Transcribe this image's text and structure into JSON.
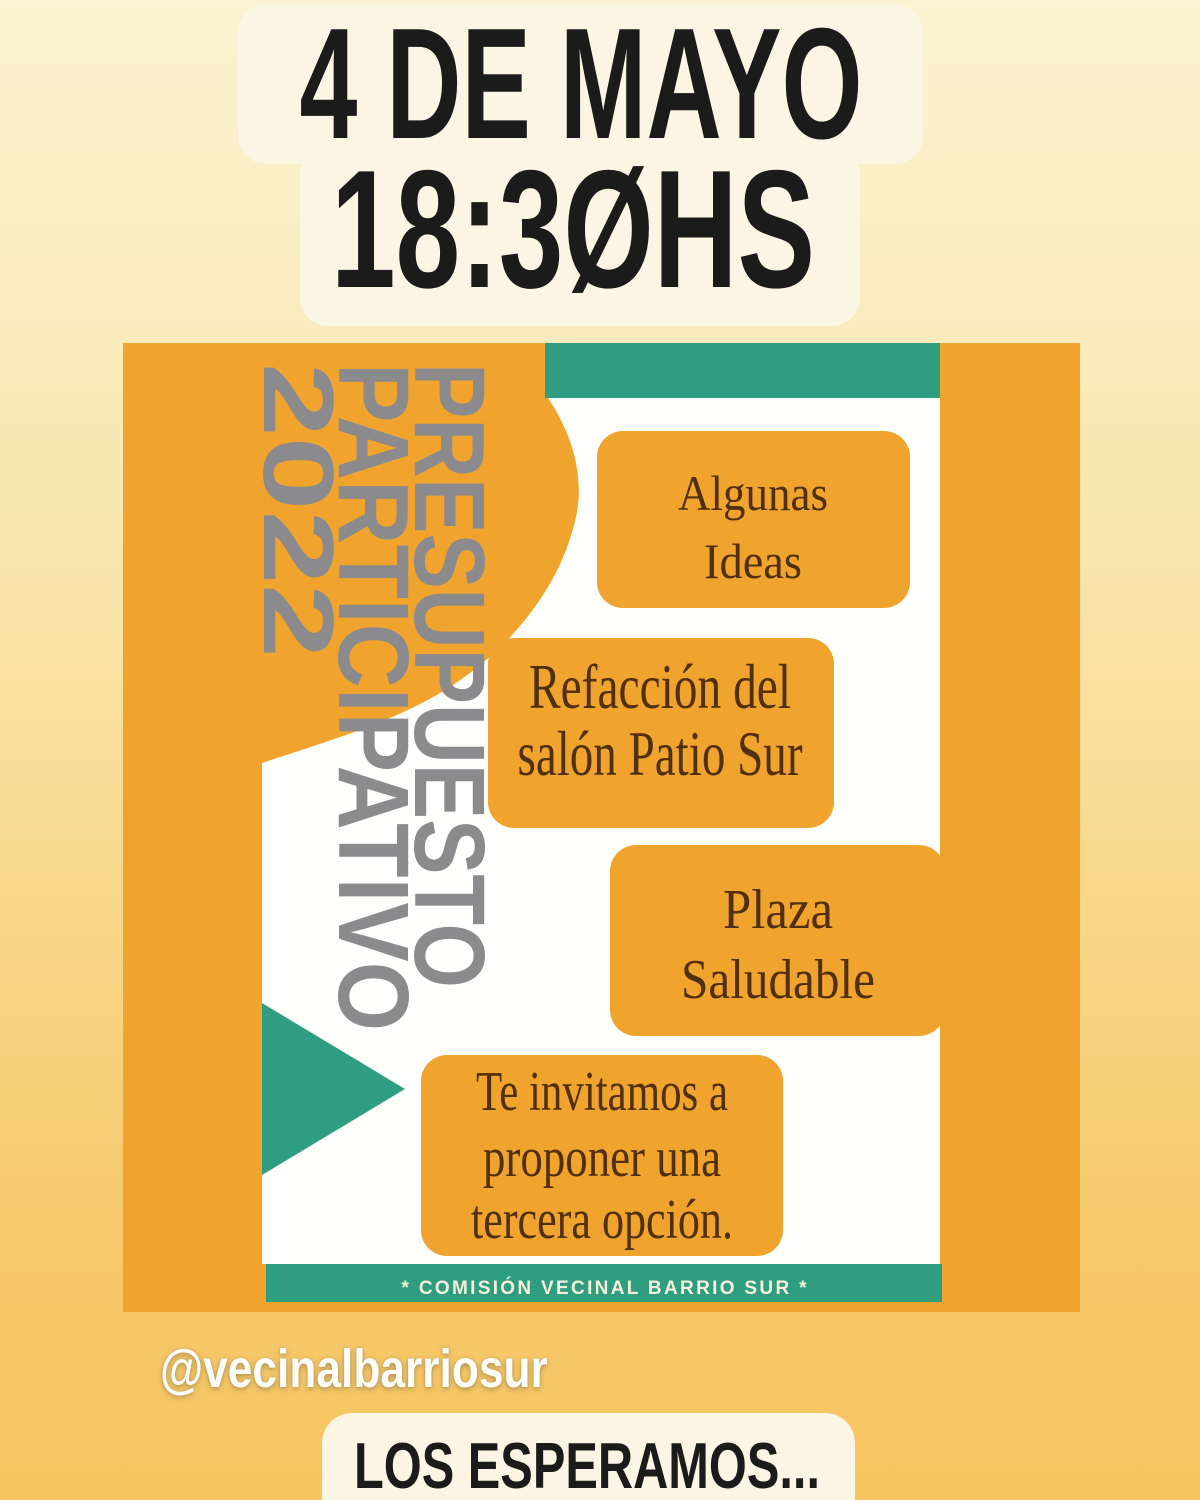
{
  "title": {
    "line1": "4 DE MAYO",
    "line2": "18:3ØHS"
  },
  "flyer": {
    "vertical_title": {
      "lines": [
        "PRESUPUESTO",
        "PARTICIPATIVO",
        "2022"
      ]
    },
    "idea_boxes": [
      {
        "id": "algunas-ideas",
        "lines": [
          "Algunas",
          "Ideas"
        ]
      },
      {
        "id": "refaccion-salon",
        "lines": [
          "Refacción del",
          "salón Patio Sur"
        ]
      },
      {
        "id": "plaza-saludable",
        "lines": [
          "Plaza",
          "Saludable"
        ]
      },
      {
        "id": "tercera-opcion",
        "lines": [
          "Te invitamos a",
          "proponer una",
          "tercera opción."
        ]
      }
    ],
    "footer_bar": "* COMISIÓN VECINAL BARRIO SUR *"
  },
  "mention": "@vecinalbarriosur",
  "footer": {
    "text": "LOS ESPERAMOS..."
  },
  "colors": {
    "background_top": "#FAF2D0",
    "background_bottom": "#F7C45F",
    "flyer_orange": "#F0A42E",
    "teal_accent": "#2F9E80",
    "card_cream": "#FBF5E4",
    "flyer_white": "#FEFEFC",
    "vertical_title_gray": "#8B8B8D",
    "box_text_brown": "#50300F",
    "title_black": "#1B1B1B"
  }
}
